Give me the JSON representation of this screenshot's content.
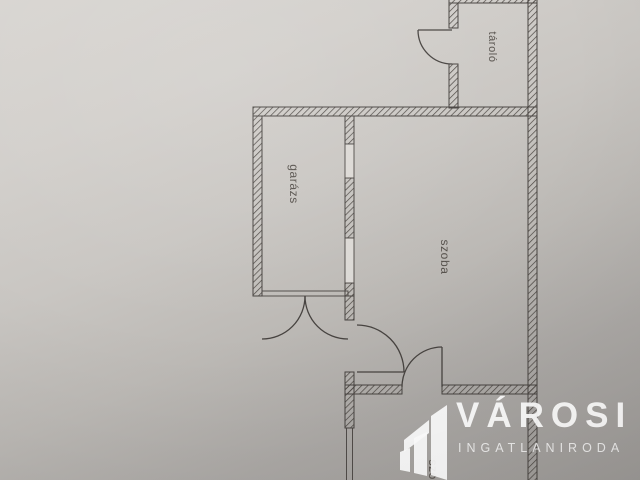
{
  "photo": {
    "rooms": {
      "storage": "tároló",
      "garage": "garázs",
      "room_main": "szoba",
      "room_bottom": "szoba"
    },
    "watermark": {
      "name": "VÁROSI",
      "subtitle": "INGATLANIRODA"
    },
    "colors": {
      "paper_light": "#d8d5d1",
      "paper_dark": "#9d9a97",
      "plan_line": "#474340",
      "watermark": "#ffffff"
    }
  }
}
